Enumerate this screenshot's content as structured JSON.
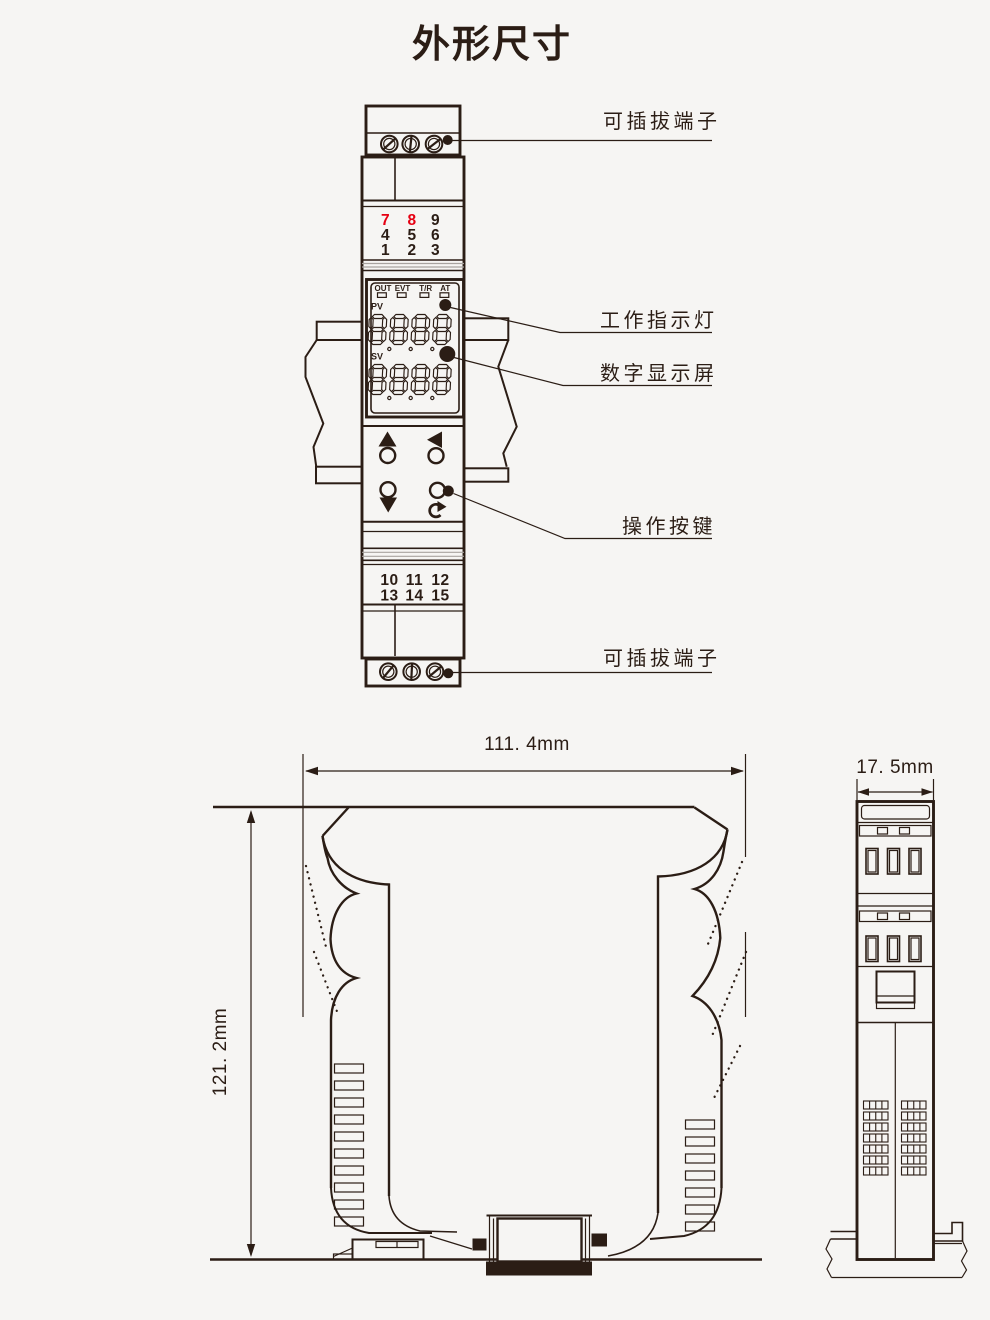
{
  "title": "外形尺寸",
  "colors": {
    "background": "#f6f5f3",
    "line": "#2b1d15",
    "red_terminal": "#e60012"
  },
  "front_view": {
    "top_terminal_rows": [
      [
        "7",
        "8",
        "9"
      ],
      [
        "4",
        "5",
        "6"
      ],
      [
        "1",
        "2",
        "3"
      ]
    ],
    "indicator_labels": [
      "OUT",
      "EVT",
      "T/R",
      "AT"
    ],
    "pv_label": "PV",
    "sv_label": "SV",
    "bottom_terminal_rows": [
      [
        "10",
        "11",
        "12"
      ],
      [
        "13",
        "14",
        "15"
      ]
    ],
    "callouts": {
      "terminal_top": "可插拔端子",
      "indicator": "工作指示灯",
      "display": "数字显示屏",
      "buttons": "操作按键",
      "terminal_bottom": "可插拔端子"
    }
  },
  "dimensions": {
    "width": "111. 4mm",
    "height": "121. 2mm",
    "depth": "17. 5mm"
  }
}
